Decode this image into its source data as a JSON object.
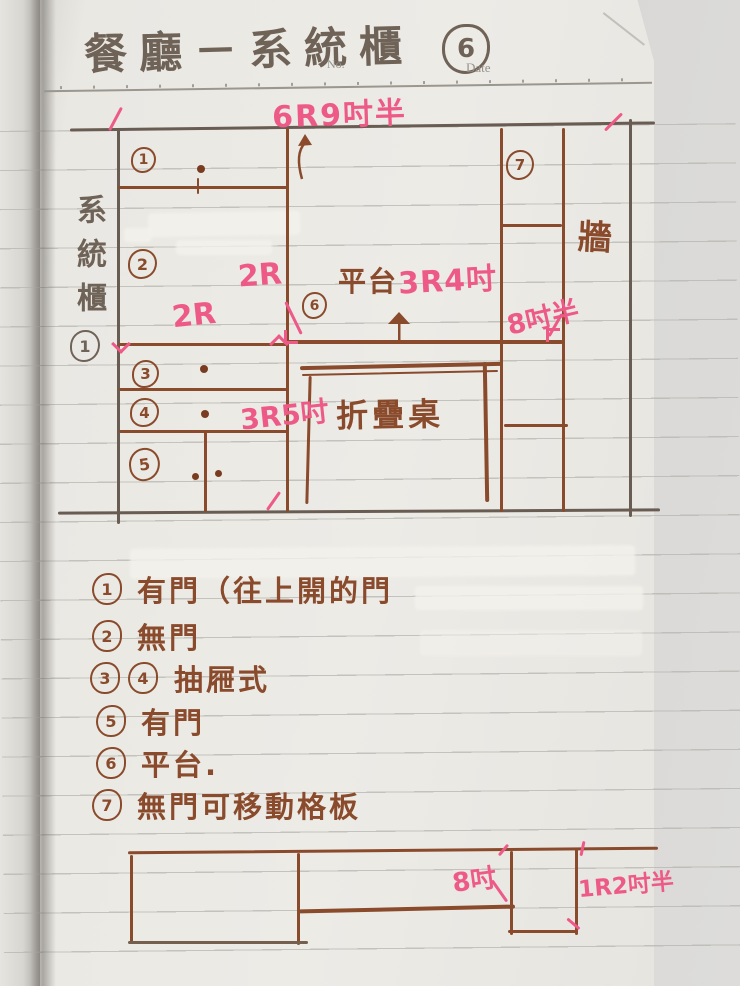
{
  "header": {
    "title_text": "餐廳－系統櫃",
    "title_num": "6",
    "no_label": "No.",
    "date_label": "Date"
  },
  "side_label": {
    "text": "系統櫃",
    "num": "1"
  },
  "diagram": {
    "width_total": "6R9吋半",
    "sections": {
      "s1": "1",
      "s2": "2",
      "s3": "3",
      "s4": "4",
      "s5": "5",
      "s6": "6",
      "s7": "7"
    },
    "labels": {
      "height_left": "2R",
      "width_left": "2R",
      "platform": "平台",
      "platform_width": "3R4吋",
      "right_gap": "8吋半",
      "table_width": "3R5吋",
      "folding_table": "折疊桌",
      "wall": "牆"
    }
  },
  "legend": {
    "items": [
      {
        "num": "1",
        "text": "有門（往上開的門"
      },
      {
        "num": "2",
        "text": "無門"
      },
      {
        "num": "3",
        "num2": "4",
        "text": "抽屜式"
      },
      {
        "num": "5",
        "text": "有門"
      },
      {
        "num": "6",
        "text": "平台."
      },
      {
        "num": "7",
        "text": "無門可移動格板"
      }
    ]
  },
  "plan": {
    "label_depth": "8吋",
    "label_height": "1R2吋半"
  },
  "colors": {
    "ink_brown": "#8a4a2c",
    "ink_pink": "#ee5a87",
    "ink_dark": "#6f6257",
    "paper": "#eae8e3"
  }
}
